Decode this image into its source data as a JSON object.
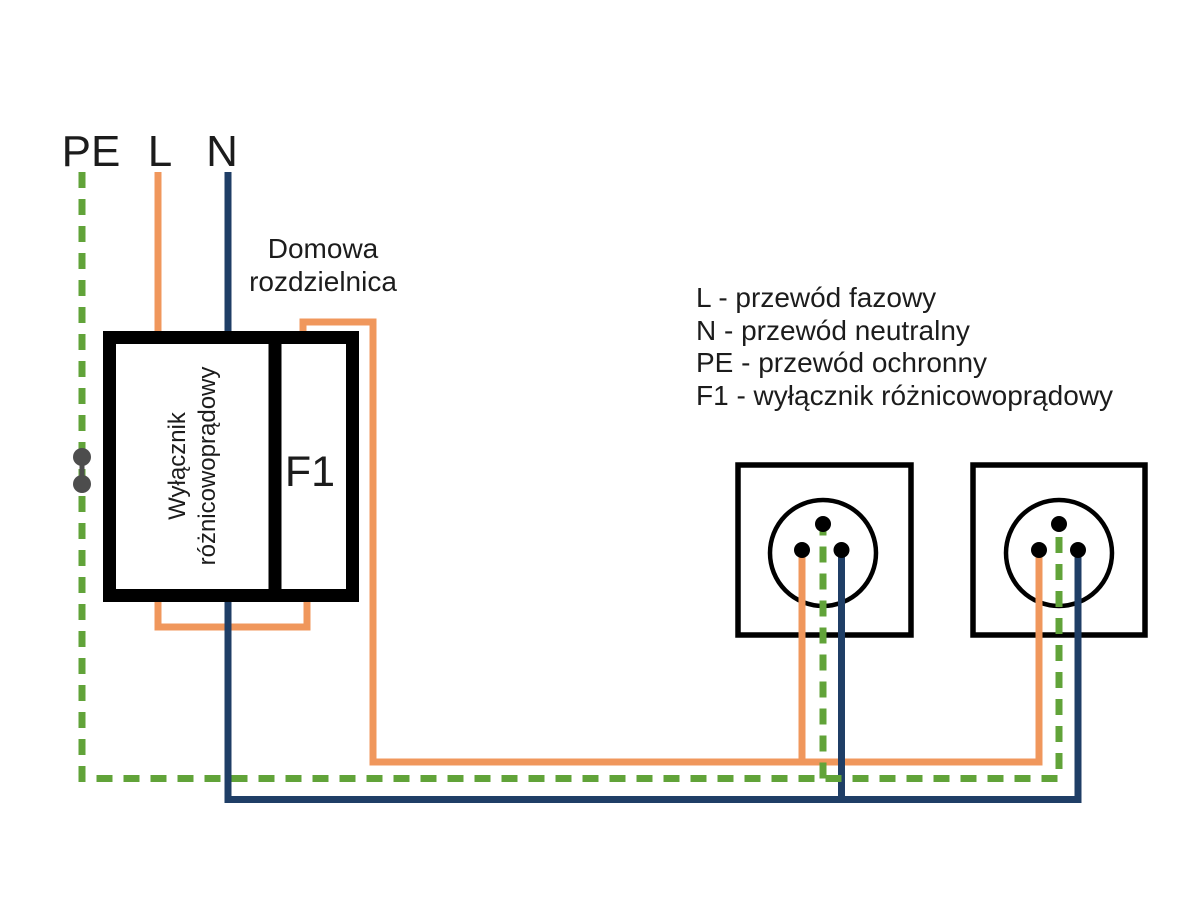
{
  "feed_labels": {
    "pe": "PE",
    "l": "L",
    "n": "N"
  },
  "panel": {
    "title_line1": "Domowa",
    "title_line2": "rozdzielnica",
    "rcd_line1": "Wyłącznik",
    "rcd_line2": "różnicowoprądowy",
    "breaker_label": "F1"
  },
  "legend": {
    "lines": [
      "L - przewód fazowy",
      "N - przewód neutralny",
      "PE - przewód ochronny",
      "F1 - wyłącznik różnicowoprądowy"
    ]
  },
  "colors": {
    "phase": "#F0975C",
    "neutral": "#1F3E66",
    "protective": "#61A339",
    "outline": "#000000",
    "connector": "#4D4D4D"
  }
}
